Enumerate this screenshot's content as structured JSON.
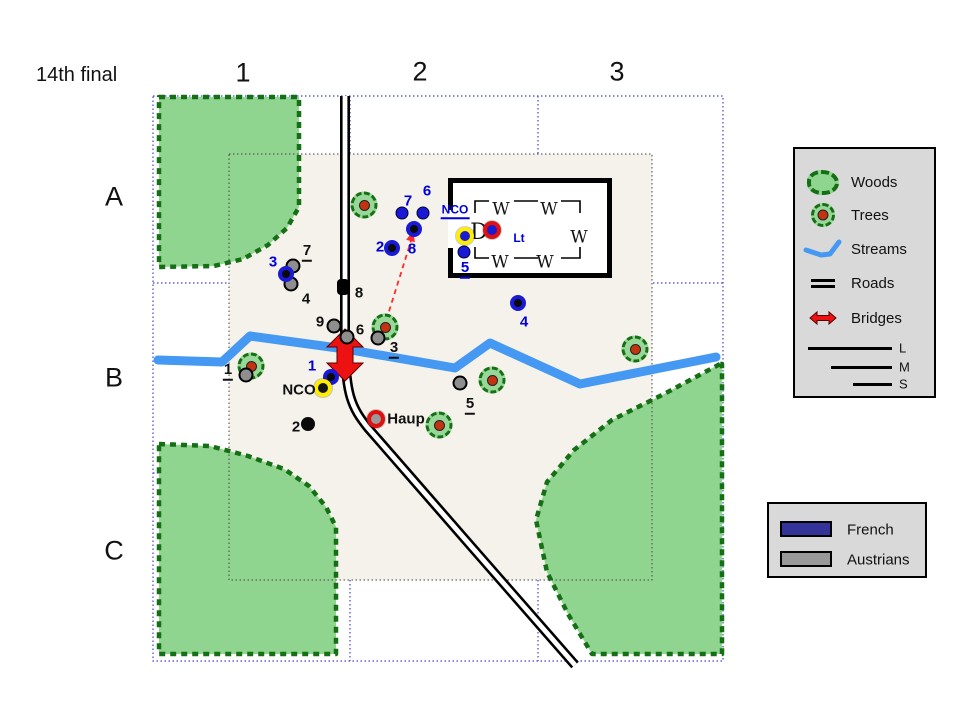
{
  "title": "14th final",
  "grid": {
    "columns": [
      "1",
      "2",
      "3"
    ],
    "rows": [
      "A",
      "B",
      "C"
    ]
  },
  "legend_terrain": {
    "items": [
      {
        "icon": "woods-icon",
        "label": "Woods"
      },
      {
        "icon": "trees-icon",
        "label": "Trees"
      },
      {
        "icon": "streams-icon",
        "label": "Streams"
      },
      {
        "icon": "roads-icon",
        "label": "Roads"
      },
      {
        "icon": "bridges-icon",
        "label": "Bridges"
      }
    ],
    "size_lines": [
      {
        "label": "L"
      },
      {
        "label": "M"
      },
      {
        "label": "S"
      }
    ]
  },
  "legend_sides": {
    "items": [
      {
        "label": "French",
        "color": "#333399"
      },
      {
        "label": "Austrians",
        "color": "#999999"
      }
    ]
  },
  "colors": {
    "french": "#1a1ad6",
    "austrian": "#8e8e8e",
    "woods_fill": "#8fd48f",
    "woods_border": "#157015",
    "stream": "#4699f2",
    "bridge": "#ee1111",
    "map_fill": "#f4f2ea",
    "grid_line": "#4040e0",
    "yellow_ring": "#ffee00",
    "red_ring": "#e01010",
    "blue_text": "#0000dd"
  },
  "map": {
    "geometry": {
      "outer_grid": {
        "x": 153,
        "y": 96,
        "w": 570,
        "h": 565,
        "v_lines": [
          350,
          538
        ],
        "h_lines": [
          283,
          473
        ]
      },
      "inner_map": {
        "x": 229,
        "y": 154,
        "w": 423,
        "h": 426
      },
      "woods": [
        "159,97 299,97 299,207 287,228 268,245 243,259 214,266 159,267",
        "159,444 210,446 248,456 284,469 309,486 326,507 336,527 336,654 159,654",
        "720,364 664,394 612,420 574,450 547,482 536,520 547,572 568,614 592,654 722,654 722,364"
      ],
      "stream": "158,360 222,362 250,336 345,349 455,368 490,343 580,384 716,357",
      "road": "M345,96 L345,340 C345,395 352,408 368,428 L470,545 L575,665",
      "bridge": "345,329 363,347 353,347 353,363 363,363 345,381 327,363 337,363 337,347 327,347",
      "attack_arrow": {
        "line": [
          381,
          337,
          411,
          241
        ],
        "head": "413.5,230.5 414.8,242.3 406.2,239.7"
      },
      "building": {
        "interior": {
          "x": 448,
          "y": 178,
          "w": 164,
          "h": 100
        },
        "walls": "M450.5,210 L450.5,180.5 L609.5,180.5 L609.5,275.5 L450.5,275.5 L450.5,248",
        "inner_lines": "M475,213 L475,201 L489,201 M514,201 L538,201 M561,201 L580,201 L580,213 M580,247 L580,258 L561,258 M538,258 L514,258 M489,258 L475,258 L475,247"
      }
    },
    "trees": [
      [
        364,
        205
      ],
      [
        385,
        327
      ],
      [
        251,
        366
      ],
      [
        635,
        349
      ],
      [
        492,
        380
      ],
      [
        439,
        425
      ]
    ],
    "building_letters": {
      "windows": [
        {
          "char": "W",
          "x": 501,
          "y": 210
        },
        {
          "char": "W",
          "x": 549,
          "y": 210
        },
        {
          "char": "W",
          "x": 579,
          "y": 238
        },
        {
          "char": "W",
          "x": 500,
          "y": 263
        },
        {
          "char": "W",
          "x": 545,
          "y": 263
        }
      ],
      "door": {
        "char": "D",
        "x": 479,
        "y": 233
      }
    },
    "french_units": [
      {
        "label": "7",
        "x": 402,
        "y": 213,
        "variant": "solid",
        "label_x": 408,
        "label_y": 201
      },
      {
        "label": "6",
        "x": 423,
        "y": 213,
        "variant": "solid",
        "label_x": 427,
        "label_y": 191
      },
      {
        "label": "8",
        "x": 414,
        "y": 229,
        "variant": "ring",
        "label_x": 412,
        "label_y": 249
      },
      {
        "label": "2",
        "x": 392,
        "y": 248,
        "variant": "ring",
        "label_x": 380,
        "label_y": 247
      },
      {
        "label": "3",
        "x": 286,
        "y": 274,
        "variant": "ring",
        "label_x": 273,
        "label_y": 262
      },
      {
        "label": "4",
        "x": 518,
        "y": 303,
        "variant": "ring",
        "label_x": 524,
        "label_y": 322
      },
      {
        "label": "5",
        "x": 464,
        "y": 252,
        "variant": "solid",
        "label_x": 465,
        "label_y": 269,
        "underline": true
      },
      {
        "label": "1",
        "x": 331,
        "y": 377,
        "variant": "ring",
        "label_x": 312,
        "label_y": 366
      }
    ],
    "austrian_units": [
      {
        "label": "7",
        "x": 293,
        "y": 266,
        "variant": "gray",
        "label_x": 307,
        "label_y": 252,
        "underline": true
      },
      {
        "label": "4",
        "x": 291,
        "y": 284,
        "variant": "gray",
        "label_x": 306,
        "label_y": 299
      },
      {
        "label": "9",
        "x": 334,
        "y": 326,
        "variant": "gray",
        "label_x": 320,
        "label_y": 322
      },
      {
        "label": "6",
        "x": 347,
        "y": 337,
        "variant": "gray",
        "label_x": 360,
        "label_y": 330
      },
      {
        "label": "3",
        "x": 378,
        "y": 338,
        "variant": "gray",
        "label_x": 394,
        "label_y": 349,
        "underline": true
      },
      {
        "label": "1",
        "x": 246,
        "y": 375,
        "variant": "gray",
        "label_x": 228,
        "label_y": 371,
        "underline": true
      },
      {
        "label": "5",
        "x": 460,
        "y": 383,
        "variant": "gray",
        "label_x": 470,
        "label_y": 405,
        "underline": true
      },
      {
        "label": "2",
        "x": 308,
        "y": 424,
        "variant": "black",
        "label_x": 296,
        "label_y": 427
      },
      {
        "label": "8",
        "x": 343,
        "y": 287,
        "variant": "black-square",
        "label_x": 359,
        "label_y": 293
      }
    ],
    "named_markers": [
      {
        "label": "NCO",
        "x": 465,
        "y": 236,
        "ring": "#ffee00",
        "center": "#1a1ace",
        "label_x": 455,
        "label_y": 211,
        "label_color": "#0000dd",
        "underline": true,
        "small": true
      },
      {
        "label": "Lt",
        "x": 492,
        "y": 230,
        "ring": "#e01010",
        "center": "#1a1ace",
        "label_x": 519,
        "label_y": 238,
        "label_color": "#0000dd",
        "small": true
      },
      {
        "label": "NCO",
        "x": 323,
        "y": 388,
        "ring": "#ffee00",
        "center": "#151515",
        "label_x": 299,
        "label_y": 390,
        "label_color": "#111111"
      },
      {
        "label": "Haup",
        "x": 376,
        "y": 419,
        "ring": "#e01010",
        "center": "#9a9a9a",
        "label_x": 406,
        "label_y": 419,
        "label_color": "#111111"
      }
    ]
  }
}
